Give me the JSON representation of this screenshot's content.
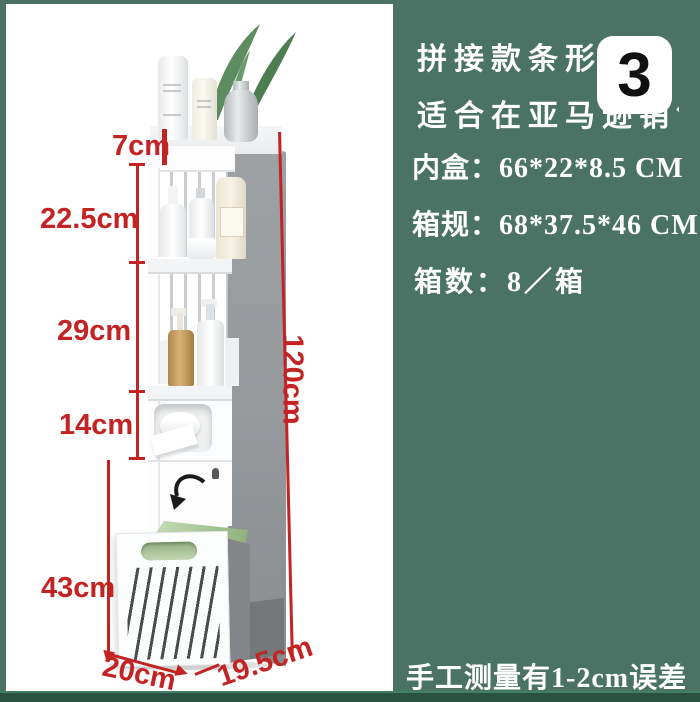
{
  "photo": {
    "dimensions": {
      "top_shelf": "7cm",
      "upper_shelf": "22.5cm",
      "middle_shelf": "29cm",
      "tissue_section": "14cm",
      "drawer": "43cm",
      "total_height": "120cm",
      "width": "20cm",
      "depth": "19.5cm"
    }
  },
  "info_panel": {
    "badge": "3",
    "title_line1": "拼接款条形带柜",
    "title_line2": "适合在亚马逊销售",
    "spec_inner_box": "内盒：66*22*8.5 CM",
    "spec_carton": "箱规：68*37.5*46 CM",
    "spec_quantity": "箱数：8／箱",
    "note": "手工测量有1-2cm误差"
  },
  "colors": {
    "background_green": "#4a7365",
    "bottom_strip_green": "#2b5143",
    "dimension_red": "#c32322",
    "badge_background": "#ffffff",
    "badge_text": "#111111",
    "panel_text": "#ffffff"
  }
}
